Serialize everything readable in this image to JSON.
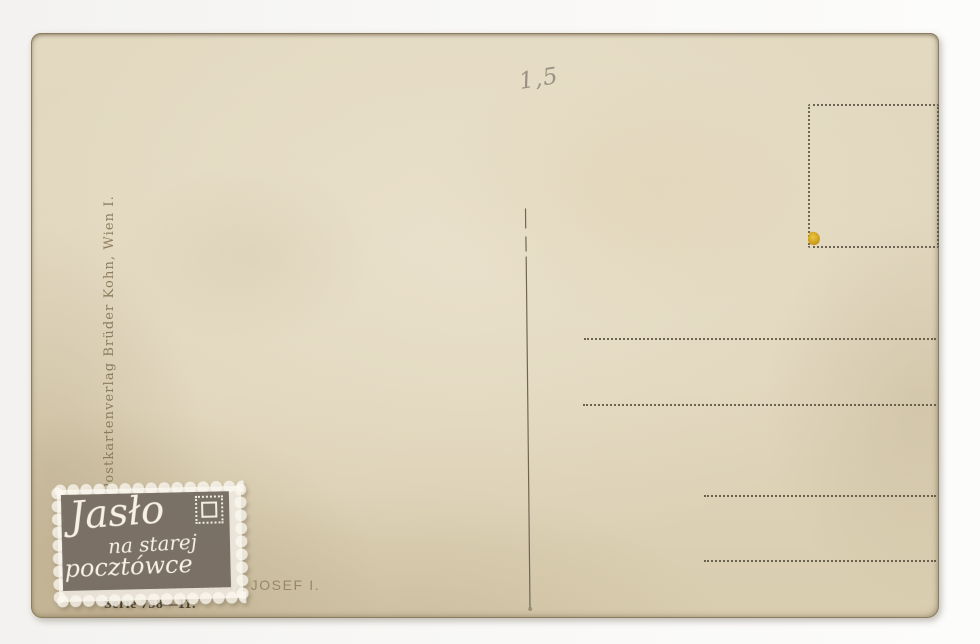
{
  "postcard": {
    "publisher_imprint": "Postkartenverlag Brüder Kohn, Wien I.",
    "handwritten_note": "1,5",
    "caption": "KAISER FRANZ JOSEF I.",
    "series_line": "Serie 758—11.",
    "address_line_count": 4
  },
  "watermark": {
    "line1": "Jasło",
    "line2": "na starej",
    "line3": "pocztówce"
  },
  "colors": {
    "card_paper": "#e1d7bf",
    "scan_background": "#f7f6f3",
    "print_ink": "#57503e",
    "pencil": "#8d8679",
    "residue_yellow": "#d7a41c",
    "watermark_panel": "#6a6156",
    "watermark_paper": "#faf7ef"
  }
}
